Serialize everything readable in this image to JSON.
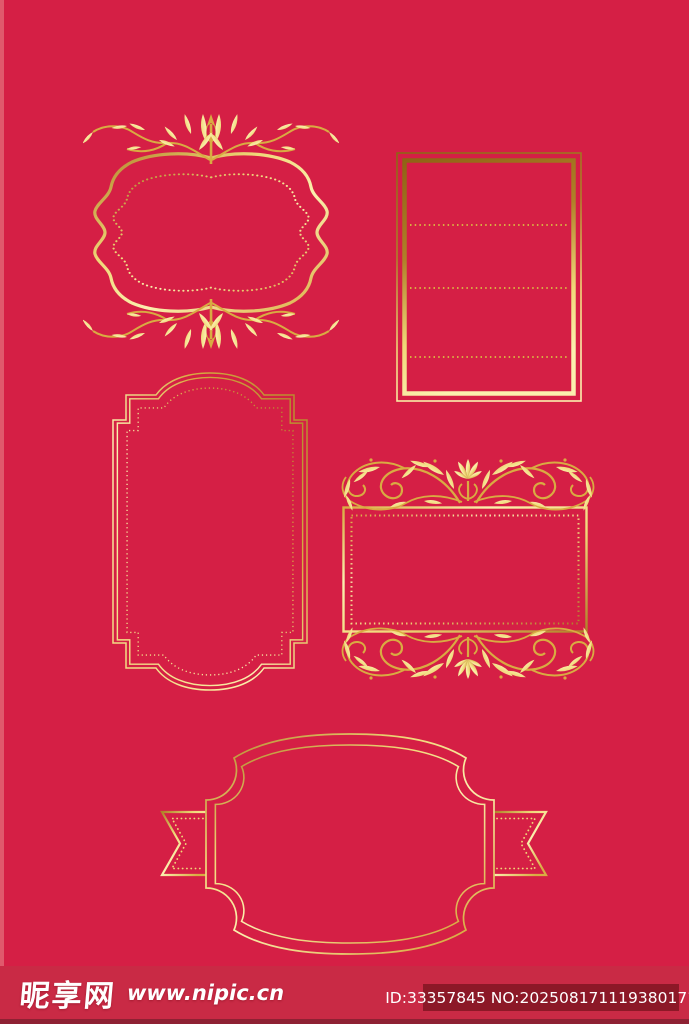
{
  "watermark": {
    "site_name": "昵享网",
    "site_url": "www.nipic.cn",
    "image_id": "ID:33357845 NO:20250817111938017102"
  },
  "colors": {
    "background": "#d51f45",
    "left-strip": "#e0596c",
    "bar": "#c92a45",
    "bar-edge": "#8e2133",
    "idbox": "#8c1827",
    "text": "#ffffff",
    "gold-1": "#8f6315",
    "gold-2": "#b08028",
    "gold-3": "#d9ab42",
    "gold-4": "#f0d878",
    "gold-5": "#fbf0ae"
  },
  "frames": [
    {
      "name": "ornate-bracket-frame"
    },
    {
      "name": "lined-panel-frame"
    },
    {
      "name": "arched-panel-frame"
    },
    {
      "name": "flourish-rect-frame"
    },
    {
      "name": "badge-ribbon-frame"
    }
  ]
}
